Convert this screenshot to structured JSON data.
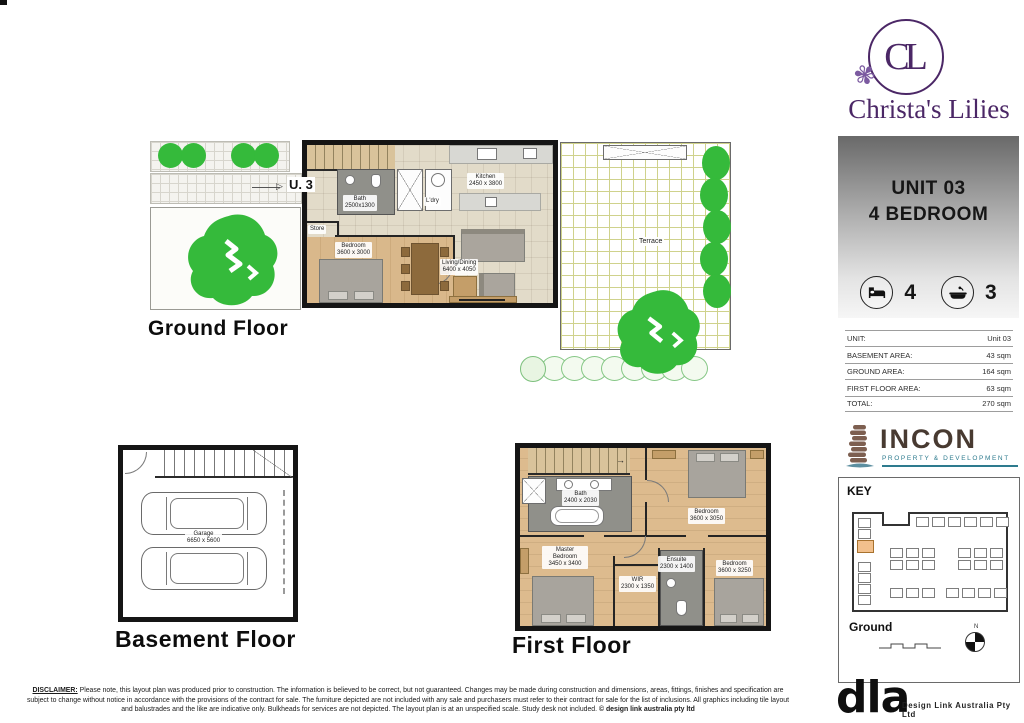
{
  "brand": {
    "monogram": "CL",
    "name": "Christa's Lilies",
    "flower_icon": "lily-flower",
    "purple": "#4b2766"
  },
  "unit_panel": {
    "line1": "UNIT 03",
    "line2": "4 BEDROOM",
    "bed_count": "4",
    "bath_count": "3"
  },
  "area_table": {
    "rows": [
      {
        "label": "UNIT:",
        "value": "Unit 03"
      },
      {
        "label": "BASEMENT AREA:",
        "value": "43 sqm"
      },
      {
        "label": "GROUND AREA:",
        "value": "164 sqm"
      },
      {
        "label": "FIRST FLOOR AREA:",
        "value": "63 sqm"
      },
      {
        "label": "TOTAL:",
        "value": "270 sqm"
      }
    ]
  },
  "incon": {
    "name": "INCON",
    "tagline": "PROPERTY & DEVELOPMENT",
    "teal": "#2e7b8e",
    "brown": "#483a31"
  },
  "key_panel": {
    "title": "KEY",
    "floor_label": "Ground",
    "north_label": "N",
    "highlight_color": "#f2c08c"
  },
  "floors": {
    "ground": {
      "label": "Ground Floor",
      "unit_marker": "U. 3",
      "rooms": {
        "bath": {
          "name": "Bath",
          "dims": "2500x1300"
        },
        "laundry": {
          "name": "L'dry"
        },
        "store": {
          "name": "Store"
        },
        "bedroom": {
          "name": "Bedroom",
          "dims": "3600 x 3000"
        },
        "kitchen": {
          "name": "Kitchen",
          "dims": "2450 x 3800"
        },
        "living": {
          "name": "Living/Dining",
          "dims": "6400 x 4050"
        },
        "terrace": {
          "name": "Terrace"
        }
      }
    },
    "basement": {
      "label": "Basement Floor",
      "rooms": {
        "garage": {
          "name": "Garage",
          "dims": "6650 x 5600"
        }
      }
    },
    "first": {
      "label": "First Floor",
      "rooms": {
        "bath": {
          "name": "Bath",
          "dims": "2400 x 2030"
        },
        "bedroom_top": {
          "name": "Bedroom",
          "dims": "3600 x 3050"
        },
        "master": {
          "name": "Master Bedroom",
          "dims": "3450 x 3400"
        },
        "bedroom_right": {
          "name": "Bedroom",
          "dims": "3600 x 3250"
        },
        "ensuite": {
          "name": "Ensuite",
          "dims": "2300 x 1400"
        },
        "wir": {
          "name": "WIR",
          "dims": "2300 x 1350"
        }
      }
    }
  },
  "disclaimer": {
    "lead": "DISCLAIMER:",
    "text": "Please note, this layout plan was produced prior to construction. The information is believed to be correct, but not guaranteed. Changes may be made during construction and dimensions, areas, fittings, finishes and specification are subject to change without notice in accordance with the provisions of the contract for sale. The furniture depicted are not included with any sale and purchasers must refer to their contract for sale for the list of inclusions. All graphics including tile layout and balustrades and the like are indicative only. Bulkheads for services are not depicted. The layout plan is at an unspecified scale. Study desk not included.",
    "copyright": "© design link australia pty ltd"
  },
  "footer": {
    "logo_text": "dla",
    "company": "Design Link Australia Pty Ltd"
  }
}
